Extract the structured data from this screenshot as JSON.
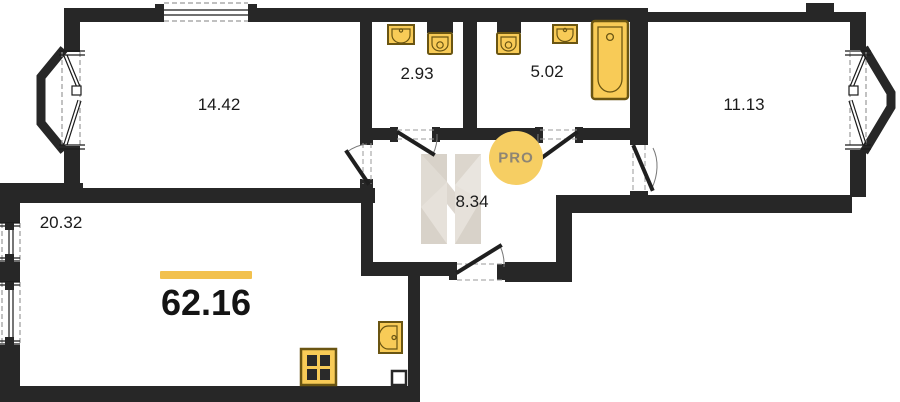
{
  "floor_plan": {
    "total_area": "62.16",
    "rooms": [
      {
        "name": "room-top-left",
        "area": "14.42"
      },
      {
        "name": "wc",
        "area": "2.93"
      },
      {
        "name": "bathroom",
        "area": "5.02"
      },
      {
        "name": "room-top-right",
        "area": "11.13"
      },
      {
        "name": "hallway",
        "area": "8.34"
      },
      {
        "name": "living-kitchen",
        "area": "20.32"
      }
    ],
    "watermark": {
      "text": "PRO"
    },
    "fixtures": [
      "wall-sink",
      "toilet",
      "toilet",
      "wall-sink",
      "bathtub",
      "kitchen-sink",
      "stove-hob"
    ],
    "colors": {
      "wall": "#272727",
      "fixture_fill": "#f8cb57",
      "fixture_stroke": "#6a5512",
      "accent_yellow": "#f2c14e",
      "watermark_circle": "#f6ce63",
      "watermark_text": "#8e8574",
      "watermark_gray": "#e6e1da"
    }
  }
}
